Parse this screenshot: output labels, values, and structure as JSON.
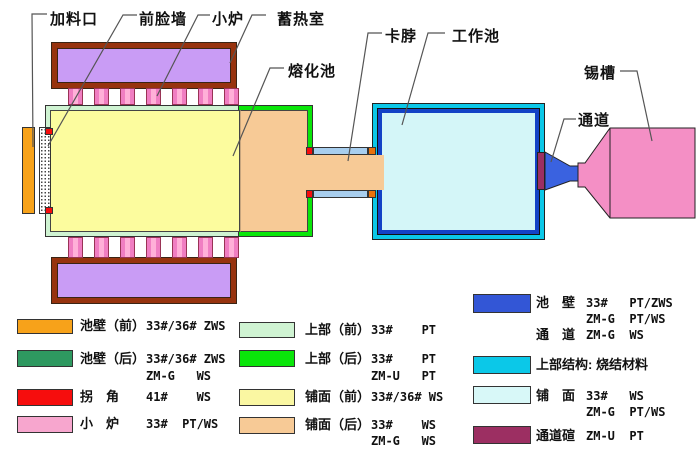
{
  "diagram": {
    "labels": {
      "feed_port": "加料口",
      "front_face_wall": "前脸墙",
      "small_furnace": "小炉",
      "regenerator": "蓄热室",
      "melting_pool": "熔化池",
      "neck": "卡脖",
      "working_pool": "工作池",
      "tin_bath": "锡槽",
      "channel": "通道"
    },
    "colors": {
      "regenerator_fill": "#C99CF5",
      "regenerator_border": "#97330E",
      "port_pink": "#FFB0D8",
      "port_stripe": "#F07EC2",
      "superstructure_front": "#CFF3D2",
      "superstructure_rear": "#0AE60A",
      "paving_front": "#FCFC9E",
      "paving_rear": "#F7CA96",
      "pool_wall_front_orange": "#F7A21A",
      "corner_red": "#F60D0D",
      "corner_orange": "#EA720B",
      "neck_wall_lightblue": "#A8CEEE",
      "working_superstructure_cyan": "#0BC8E8",
      "working_wall_blue": "#1342C6",
      "working_paving_palecyan": "#D4F6F8",
      "channel_blue": "#3A62E0",
      "channel_arch_maroon": "#9C2F62",
      "tin_bath_pink": "#F48FC5"
    }
  },
  "legend": {
    "col1": [
      {
        "term": "池壁（前）",
        "color": "#F7A21A",
        "lines": [
          "33#/36# ZWS"
        ]
      },
      {
        "term": "池壁（后）",
        "color": "#2E9960",
        "lines": [
          "33#/36# ZWS",
          "ZM-G   WS"
        ]
      },
      {
        "term": "拐　角",
        "color": "#F60D0D",
        "lines": [
          "41#    WS"
        ]
      },
      {
        "term": "小　炉",
        "color": "#F7A6CE",
        "lines": [
          "33#  PT/WS"
        ]
      }
    ],
    "col2": [
      {
        "term": "上部（前）",
        "color": "#CFF3D2",
        "lines": [
          "33#    PT"
        ]
      },
      {
        "term": "上部（后）",
        "color": "#0AE60A",
        "lines": [
          "33#    PT",
          "ZM-U   PT"
        ]
      },
      {
        "term": "铺面（前）",
        "color": "#FAF7A2",
        "lines": [
          "33#/36# WS"
        ]
      },
      {
        "term": "铺面（后）",
        "color": "#F7CA96",
        "lines": [
          "33#    WS",
          "ZM-G   WS"
        ]
      }
    ],
    "col3": [
      {
        "term": "池　壁",
        "term2": "通　道",
        "color": "#3356D6",
        "lines": [
          "33#   PT/ZWS",
          "ZM-G  PT/WS"
        ],
        "line3": "ZM-G  WS"
      },
      {
        "term": "上部结构: 烧结材料",
        "color": "#0BC8E8",
        "lines": []
      },
      {
        "term": "铺　面",
        "color": "#D8F8F8",
        "lines": [
          "33#   WS",
          "ZM-G  PT/WS"
        ]
      },
      {
        "term": "通道碹",
        "color": "#9C2F62",
        "lines": [
          "ZM-U  PT"
        ]
      }
    ]
  }
}
